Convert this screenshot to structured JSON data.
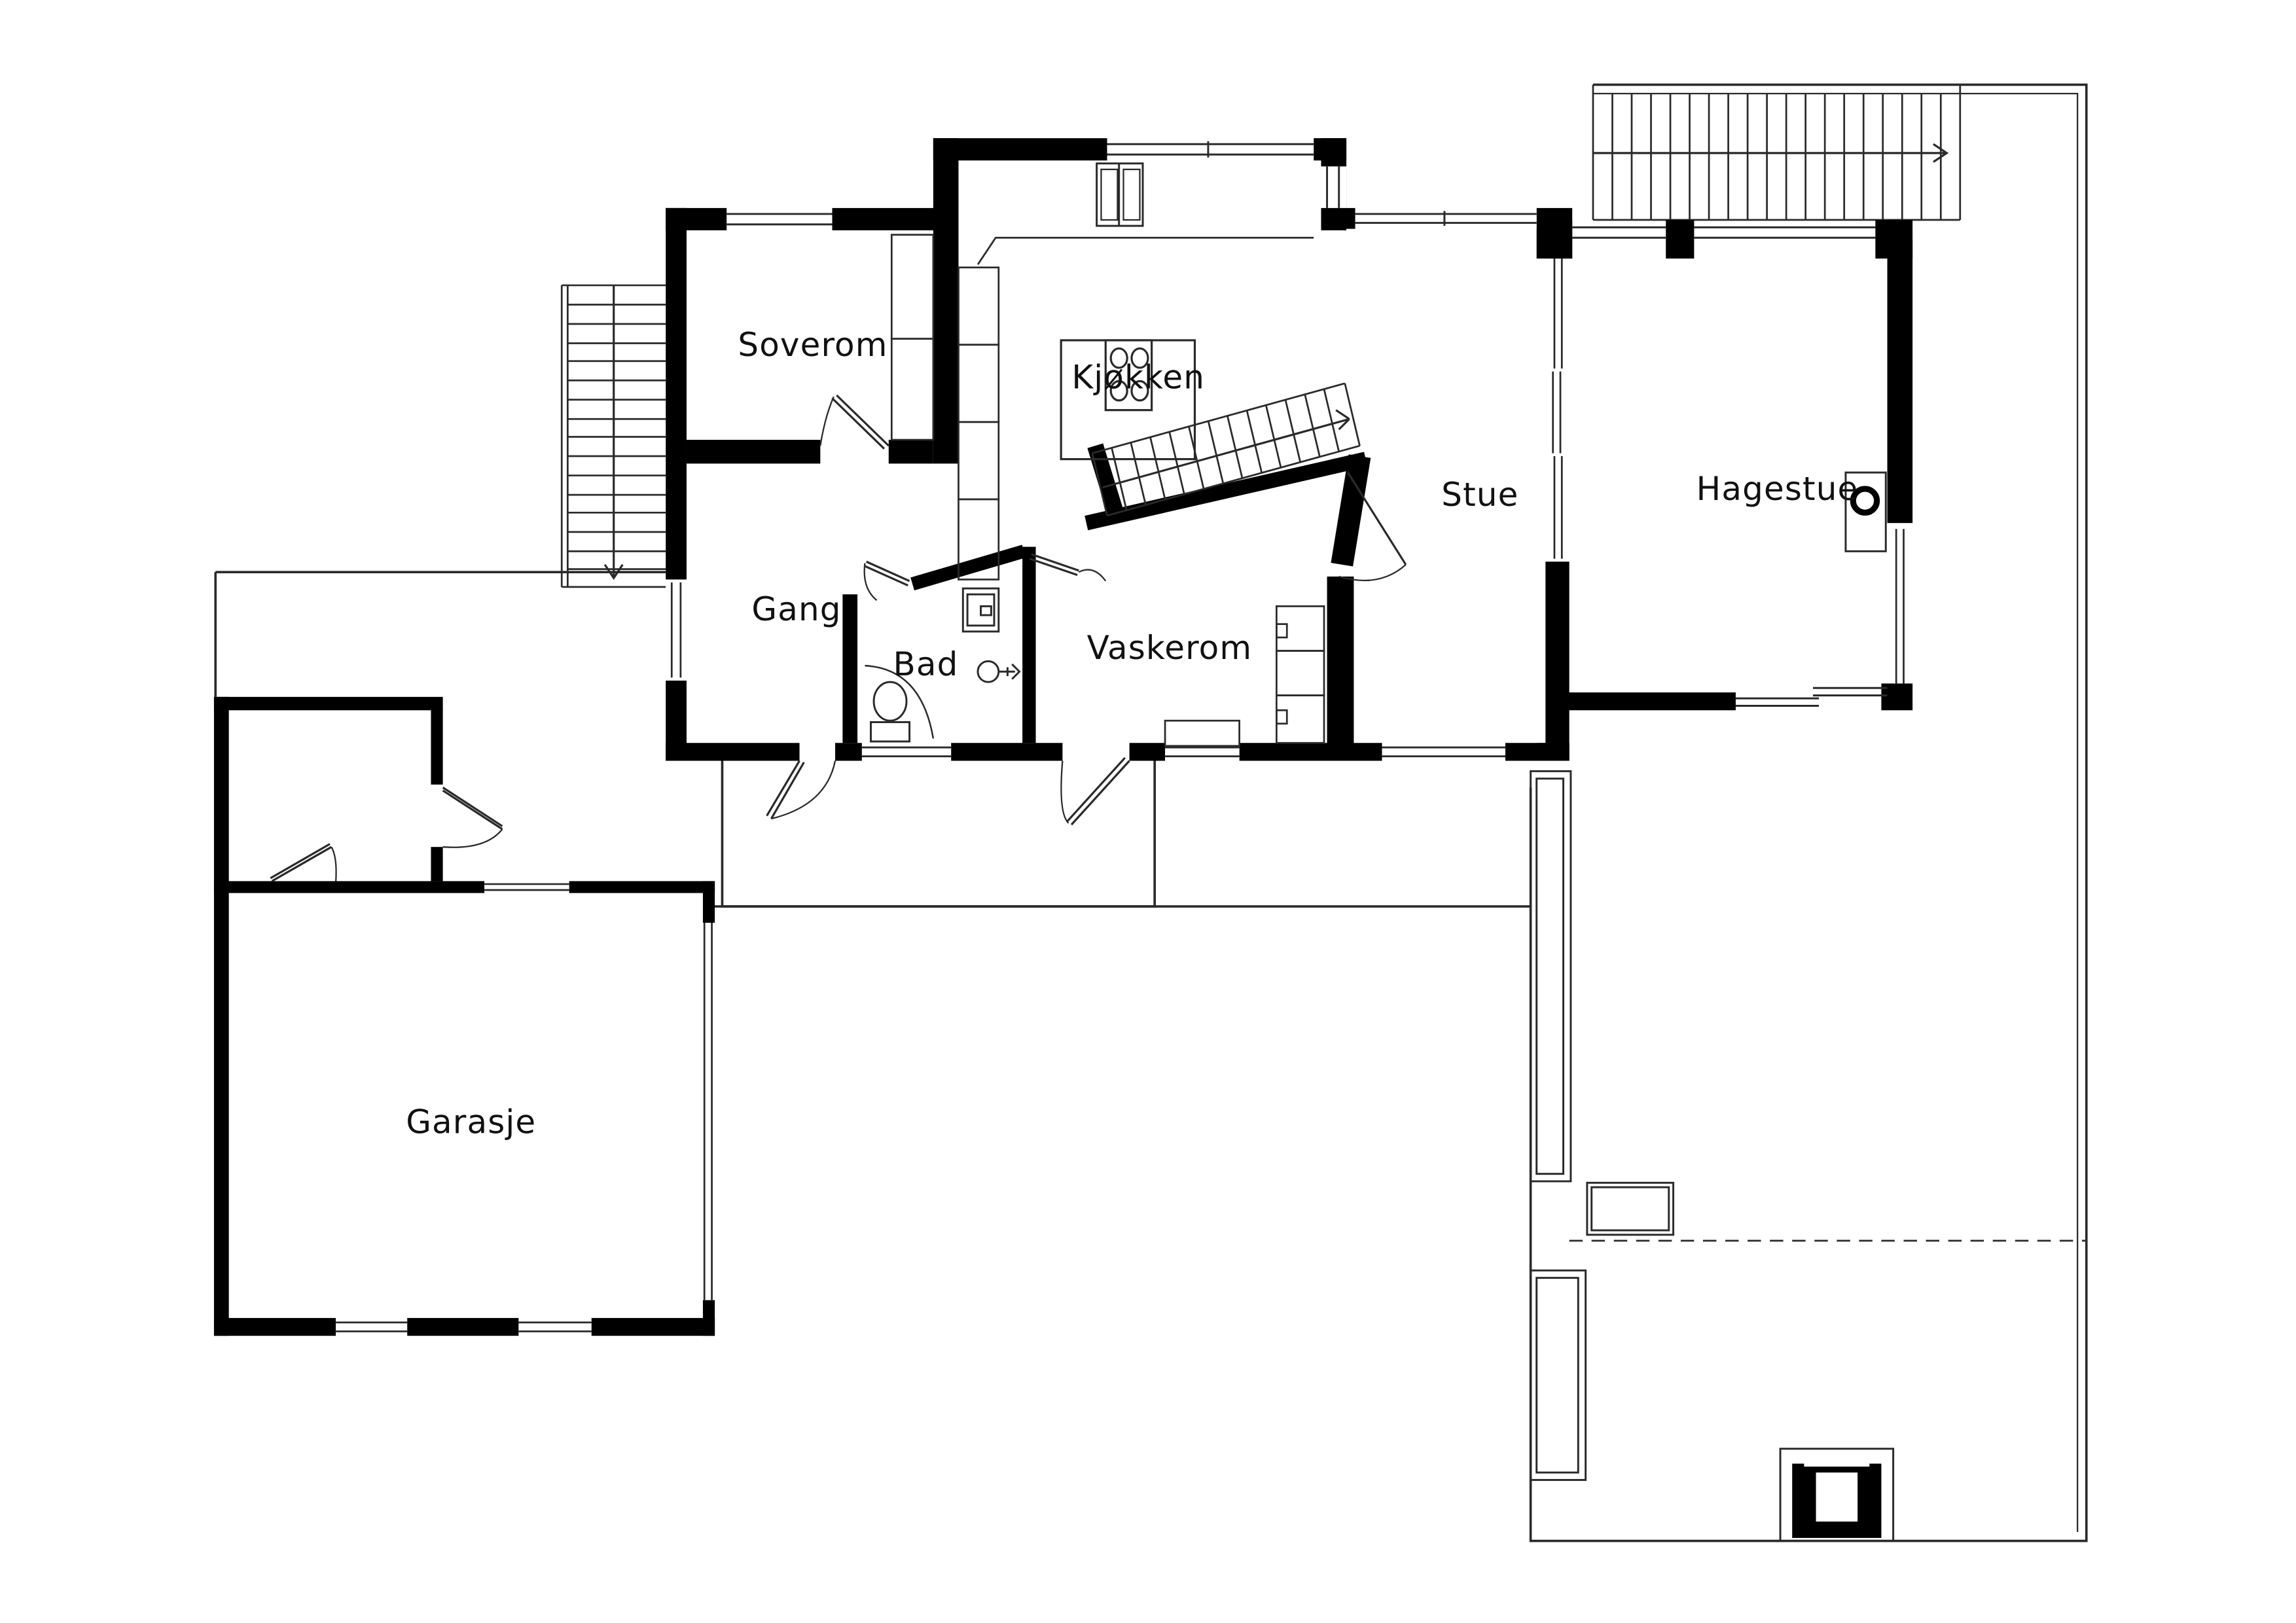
{
  "document": {
    "type": "architectural floor plan",
    "language": "Norwegian"
  },
  "rooms": [
    {
      "id": "soverom",
      "label": "Soverom"
    },
    {
      "id": "kjokken",
      "label": "Kjøkken"
    },
    {
      "id": "stue",
      "label": "Stue"
    },
    {
      "id": "hagestue",
      "label": "Hagestue"
    },
    {
      "id": "gang",
      "label": "Gang"
    },
    {
      "id": "bad",
      "label": "Bad"
    },
    {
      "id": "vaskerom",
      "label": "Vaskerom"
    },
    {
      "id": "garasje",
      "label": "Garasje"
    }
  ],
  "colors": {
    "background": "#ffffff",
    "wall": "#000000",
    "line": "#2a2a2a"
  },
  "icons": [
    "stove-icon",
    "fireplace-icon",
    "toilet-icon",
    "sink-icon",
    "shower-icon",
    "kitchen-island",
    "wardrobe",
    "cabinets",
    "bench",
    "washer-cabinets",
    "exterior-stairs-left",
    "terrace-stairs",
    "interior-stairs",
    "door-swing",
    "window",
    "planter",
    "hot-tub"
  ]
}
